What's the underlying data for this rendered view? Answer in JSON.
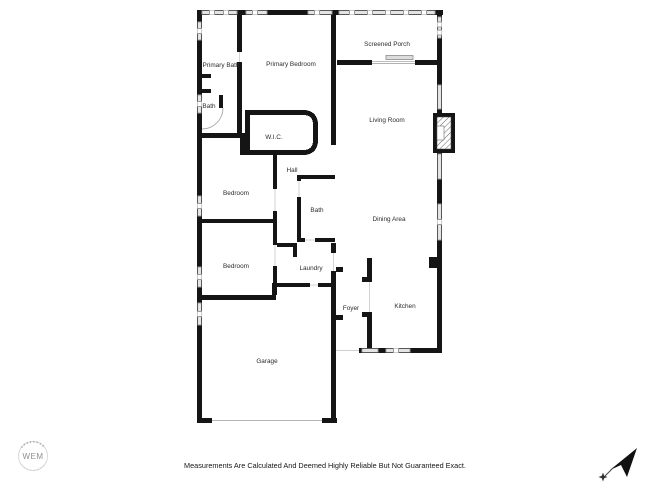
{
  "floor_plan": {
    "rooms": [
      {
        "label": "Screened Porch"
      },
      {
        "label": "Primary Bath"
      },
      {
        "label": "Primary Bedroom"
      },
      {
        "label": "Bath"
      },
      {
        "label": "W.I.C."
      },
      {
        "label": "Living Room"
      },
      {
        "label": "Hall"
      },
      {
        "label": "Bedroom"
      },
      {
        "label": "Bath"
      },
      {
        "label": "Dining Area"
      },
      {
        "label": "Bedroom"
      },
      {
        "label": "Laundry"
      },
      {
        "label": "Foyer"
      },
      {
        "label": "Kitchen"
      },
      {
        "label": "Garage"
      }
    ],
    "colors": {
      "wall": "#151515",
      "window_fill": "#e4e4e4",
      "label_text": "#2b2b2b"
    }
  },
  "logo": {
    "text": "WEM"
  },
  "footer": {
    "disclaimer": "Measurements Are Calculated And Deemed Highly Reliable But Not Guaranteed Exact."
  }
}
